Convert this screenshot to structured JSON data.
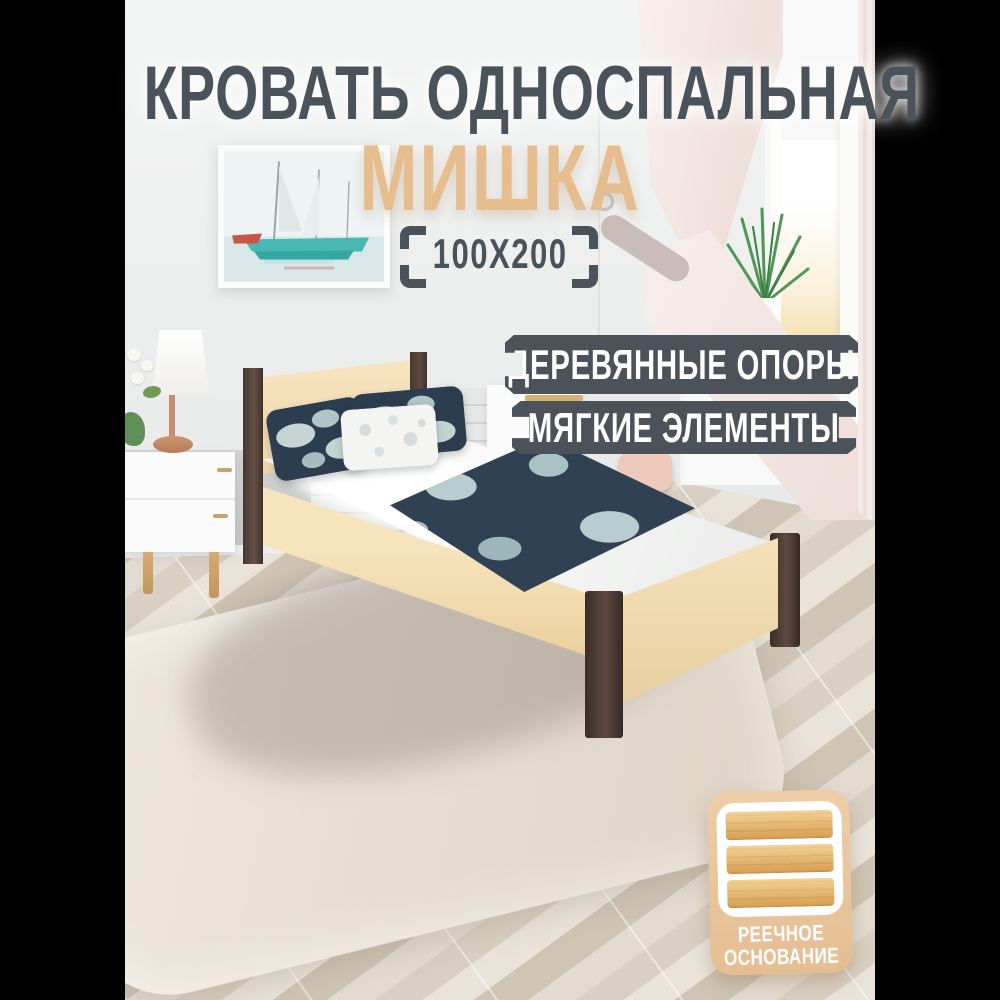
{
  "product_card": {
    "title": "КРОВАТЬ ОДНОСПАЛЬНАЯ",
    "model_name": "МИШКА",
    "dimensions": "100X200",
    "feature_badges": [
      {
        "label": "ДЕРЕВЯННЫЕ ОПОРЫ"
      },
      {
        "label": "МЯГКИЕ ЭЛЕМЕНТЫ"
      }
    ],
    "base_feature": {
      "icon": "bed-slats-icon",
      "line1": "РЕЕЧНОЕ",
      "line2": "ОСНОВАНИЕ"
    },
    "colors": {
      "title_text": "#4a525b",
      "model_text": "#e6bd8e",
      "badge_background": "#4b525a",
      "badge_text": "#ffffff",
      "card_background": "#e9c59c",
      "bed_frame": "#f2ddb6",
      "bed_legs": "#4a3a30",
      "pillow_navy": "#2c3d50"
    }
  }
}
